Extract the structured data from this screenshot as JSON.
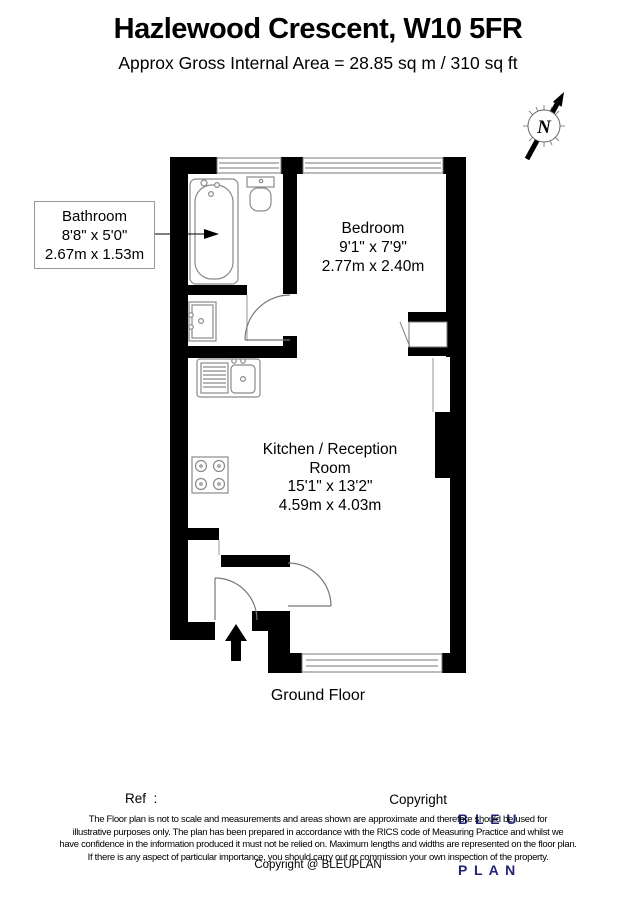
{
  "header": {
    "title": "Hazlewood Crescent, W10 5FR",
    "subtitle": "Approx Gross Internal Area = 28.85 sq m / 310 sq ft"
  },
  "compass": {
    "label": "N"
  },
  "rooms": {
    "bathroom": {
      "name": "Bathroom",
      "imperial": "8'8\" x 5'0\"",
      "metric": "2.67m x 1.53m"
    },
    "bedroom": {
      "name": "Bedroom",
      "imperial": "9'1\" x 7'9\"",
      "metric": "2.77m x 2.40m"
    },
    "kitchen": {
      "name_line1": "Kitchen / Reception",
      "name_line2": "Room",
      "imperial": "15'1\" x 13'2\"",
      "metric": "4.59m x 4.03m"
    }
  },
  "floor_label": "Ground Floor",
  "footer": {
    "ref_label": "Ref  :",
    "copyright_label": "Copyright",
    "logo_line1": "B L E U",
    "logo_line2": "P L A N",
    "logo_color": "#232377",
    "disclaimer": [
      "The Floor plan is not to scale and measurements and areas shown are approximate and therefore should be used for",
      "illustrative purposes only. The plan has been prepared in accordance with the RICS code of Measuring Practice and whilst we",
      "have confidence in the information produced it must not be relied on. Maximum lengths and widths are represented on the floor plan.",
      "If there is any aspect of particular importance, you should carry out or commission your own inspection of the property."
    ],
    "copyright_line": "Copyright @ BLEUPLAN"
  }
}
